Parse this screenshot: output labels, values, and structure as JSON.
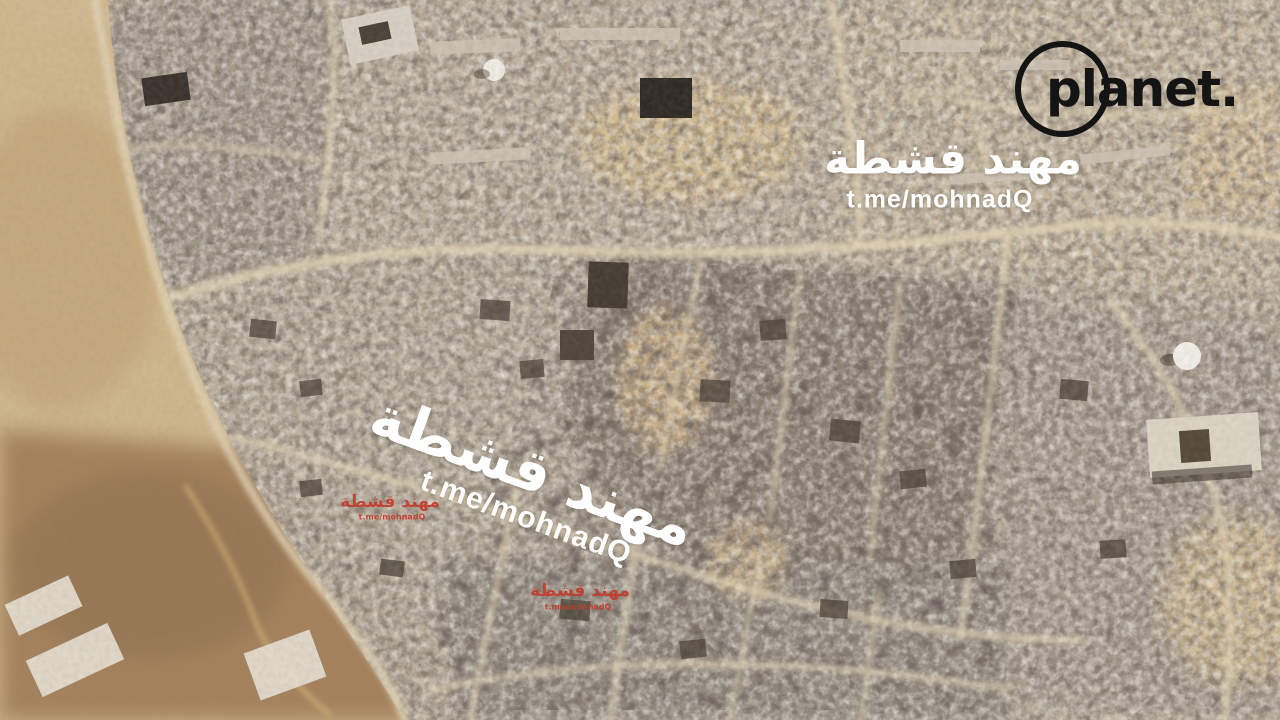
{
  "branding": {
    "logo_text": "planet."
  },
  "watermarks": {
    "top_right": {
      "arabic": "مهند قشطة",
      "telegram": "t.me/mohnadQ"
    },
    "center": {
      "arabic": "مهند قشطة",
      "telegram": "t.me/mohnadQ"
    },
    "red_left": {
      "arabic": "مهند قشطة",
      "telegram": "t.me/mohnadQ"
    },
    "red_center": {
      "arabic": "مهند قشطة",
      "telegram": "t.me/mohnadQ"
    }
  },
  "colors": {
    "sand": "#d4bd97",
    "earth_brown": "#a3805a",
    "rubble_gray": "#a79b8d",
    "rubble_dark": "#4a4036",
    "road_light": "#e3d5b6",
    "watermark_white": "#ffffff",
    "watermark_red": "#c23a2a",
    "logo_black": "#141414"
  }
}
